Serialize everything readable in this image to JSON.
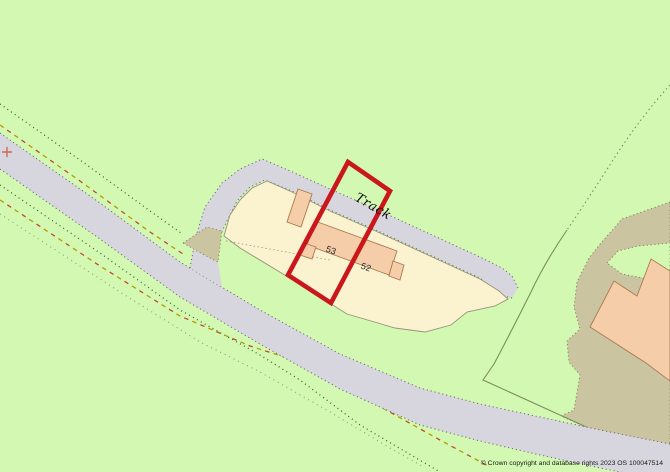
{
  "map": {
    "labels": {
      "track": "Track",
      "building_53": "53",
      "building_52": "52"
    },
    "attribution": "© Crown copyright and database rights 2023 OS 100047514",
    "features": {
      "highlight_boundary": "red property outline around plot containing buildings 53 and 52",
      "road": "grey road running diagonally from upper left to lower right",
      "track": "grey track branching north-east past the buildings",
      "scrub_area": "khaki vegetation area at lower right with large building",
      "grid_cross_marker": "+"
    }
  },
  "colors": {
    "background": "#d2f8b2",
    "road_fill": "#d7d6de",
    "road_casing": "#6b6b6b",
    "parcel_fill": "#fbf3cf",
    "parcel_line": "#98937c",
    "building_fill": "#f5cda9",
    "building_stroke": "#aa7b52",
    "scrub_fill": "#cac4a0",
    "scrub_line": "#85855f",
    "field_line": "#7b8f5a",
    "highlight_red": "#c9171c",
    "path_green": "#2f6e1e",
    "path_yellow": "#b59c00",
    "path_red": "#c04b28",
    "path_faint": "#87a477",
    "grid_cross": "#cc6a55",
    "label_text": "#111111"
  }
}
